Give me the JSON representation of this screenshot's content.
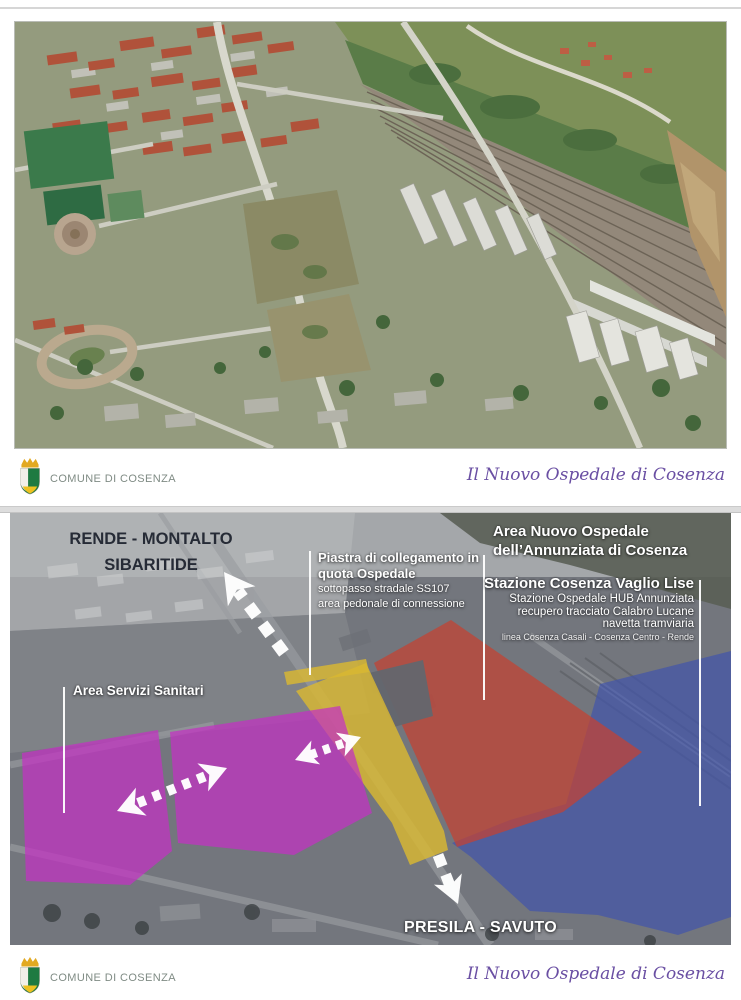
{
  "footer": {
    "org": "COMUNE DI COSENZA",
    "title": "Il Nuovo Ospedale di Cosenza"
  },
  "colors": {
    "org_text": "#7f8b84",
    "title_text": "#6a4fa3",
    "overlay_area_servizi": "#c431c4",
    "overlay_piastra": "#d9b832",
    "overlay_area_ospedale": "#c8402f",
    "overlay_stazione": "#3e52ae"
  },
  "map_labels": {
    "rende": {
      "line1": "RENDE - MONTALTO",
      "line2": "SIBARITIDE"
    },
    "piastra": {
      "title": "Piastra di collegamento in quota Ospedale",
      "subs": [
        "sottopasso stradale SS107",
        "area pedonale di connessione"
      ]
    },
    "ospedale": {
      "line1": "Area Nuovo Ospedale",
      "line2": "dell’Annunziata di Cosenza"
    },
    "stazione": {
      "title": "Stazione Cosenza Vaglio Lise",
      "subs": [
        "Stazione Ospedale HUB Annunziata",
        "recupero tracciato Calabro Lucane",
        "navetta tramviaria",
        "linea Cosenza Casali - Cosenza Centro - Rende"
      ]
    },
    "servizi": {
      "title": "Area Servizi Sanitari"
    },
    "presila": {
      "title": "PRESILA - SAVUTO"
    }
  }
}
